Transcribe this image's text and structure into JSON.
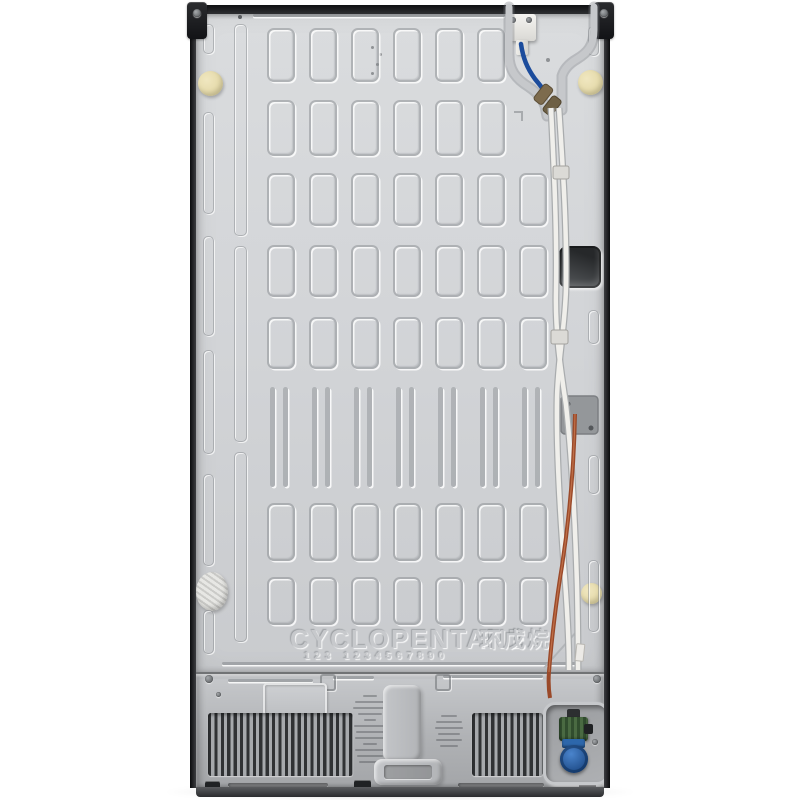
{
  "meta": {
    "subject": "Refrigerator rear view product photo",
    "background": "#ffffff"
  },
  "embossing": {
    "refrigerant_label": "CYCLOPENTANE",
    "refrigerant_label_cn": "环戊烷",
    "stamp_digits": "123 1234567890"
  },
  "panel": {
    "grid": {
      "col_start": 267,
      "col_pitch": 42,
      "col_width": 24,
      "columns": 7,
      "rows": [
        {
          "y": 28,
          "h": 50,
          "type": "rect",
          "skip": [
            6
          ]
        },
        {
          "y": 100,
          "h": 52,
          "type": "rect",
          "skip": [
            6
          ]
        },
        {
          "y": 173,
          "h": 49,
          "type": "rect",
          "skip": []
        },
        {
          "y": 245,
          "h": 48,
          "type": "rect",
          "skip": []
        },
        {
          "y": 317,
          "h": 48,
          "type": "rect",
          "skip": []
        },
        {
          "y": 387,
          "h": 100,
          "type": "slat",
          "skip": []
        },
        {
          "y": 503,
          "h": 54,
          "type": "rect",
          "skip": []
        },
        {
          "y": 577,
          "h": 44,
          "type": "rect",
          "skip": []
        }
      ],
      "rails": [
        {
          "x": 203,
          "w": 9,
          "segments": [
            [
              24,
              28
            ],
            [
              112,
              100
            ],
            [
              236,
              98
            ],
            [
              350,
              102
            ],
            [
              474,
              90
            ],
            [
              610,
              42
            ]
          ]
        },
        {
          "x": 234,
          "w": 11,
          "segments": [
            [
              24,
              210
            ],
            [
              246,
              194
            ],
            [
              452,
              188
            ]
          ]
        },
        {
          "x": 588,
          "w": 9,
          "segments": [
            [
              26,
              28
            ],
            [
              310,
              32
            ],
            [
              455,
              37
            ],
            [
              560,
              70
            ]
          ]
        }
      ]
    }
  },
  "colors": {
    "panel_light": "#d9dbdd",
    "panel_dark": "#c9cbce",
    "trim_black": "#141518",
    "machine_gray": "#bfc1c4",
    "vent_slot": "#303234",
    "pad_cream": "#e9dfae",
    "wire_blue": "#1c4c9c",
    "tube_white": "#f0efeb",
    "tube_copper": "#9a4929",
    "brass_fitting": "#7d6b4d",
    "valve_green": "#3f5c3a",
    "valve_blue": "#2d67ab"
  }
}
